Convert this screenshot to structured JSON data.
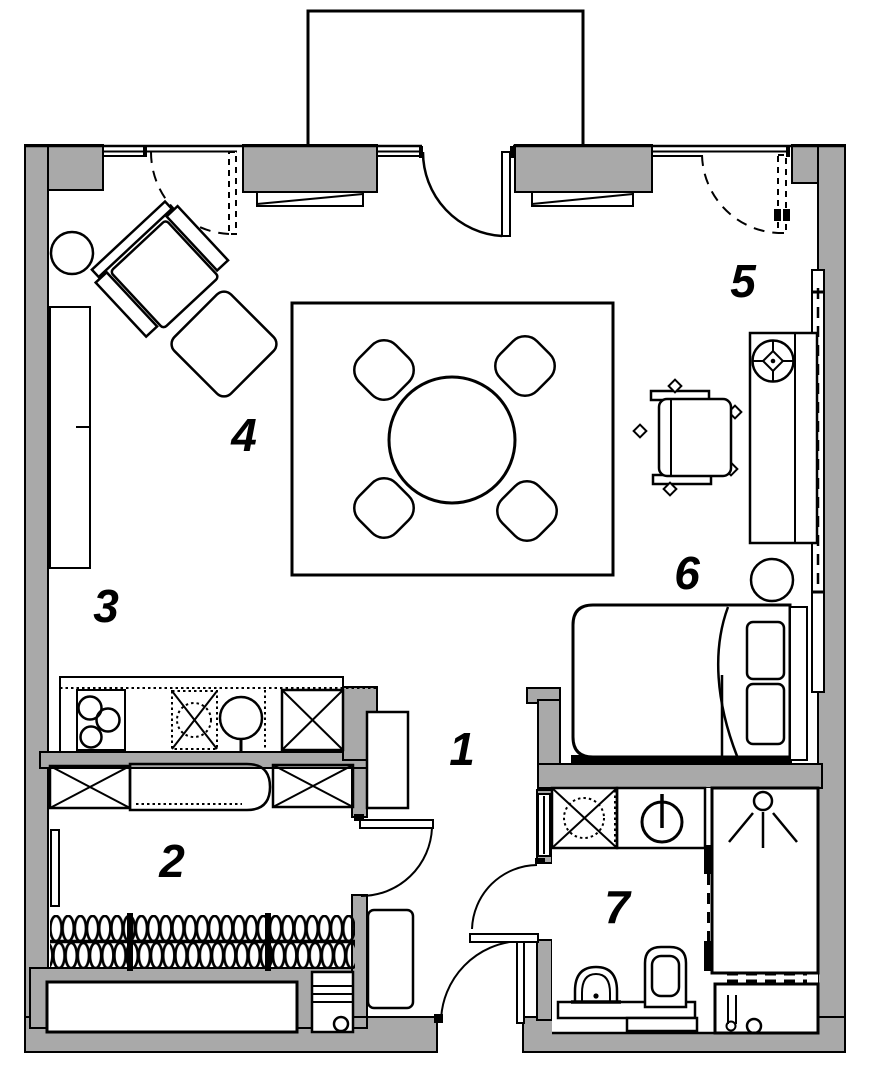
{
  "floorplan": {
    "type": "apartment-floor-plan",
    "room_labels": [
      {
        "number": "1"
      },
      {
        "number": "2"
      },
      {
        "number": "3"
      },
      {
        "number": "4"
      },
      {
        "number": "5"
      },
      {
        "number": "6"
      },
      {
        "number": "7"
      }
    ],
    "colors": {
      "wall": "#a9a9a9",
      "lines": "#000000",
      "background": "#ffffff"
    }
  }
}
